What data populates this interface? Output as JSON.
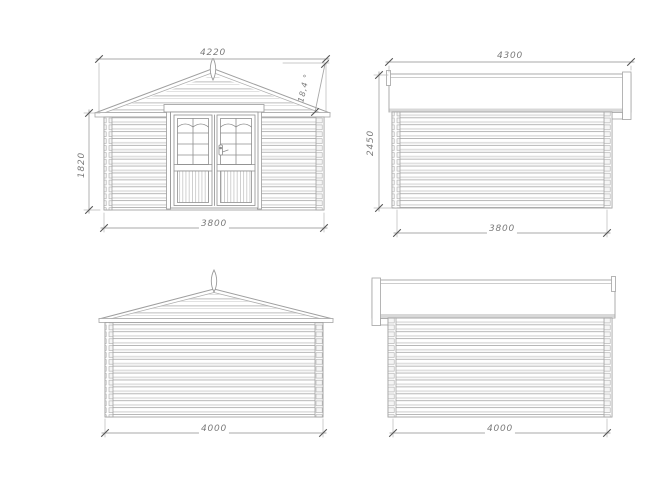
{
  "views": {
    "front": {
      "dim_top": "4220",
      "dim_angle": "18,4 °",
      "dim_left": "1820",
      "dim_bottom": "3800"
    },
    "side_a": {
      "dim_top": "4300",
      "dim_left": "2450",
      "dim_bottom": "3800"
    },
    "rear": {
      "dim_bottom": "4000"
    },
    "side_b": {
      "dim_bottom": "4000"
    }
  },
  "colors": {
    "background": "#ffffff",
    "outline": "#a3a3a3",
    "shade": "#d8d8d8",
    "dimension_line": "#a8a8a8",
    "tick": "#555555",
    "dimension_text": "#7b7b7b"
  }
}
